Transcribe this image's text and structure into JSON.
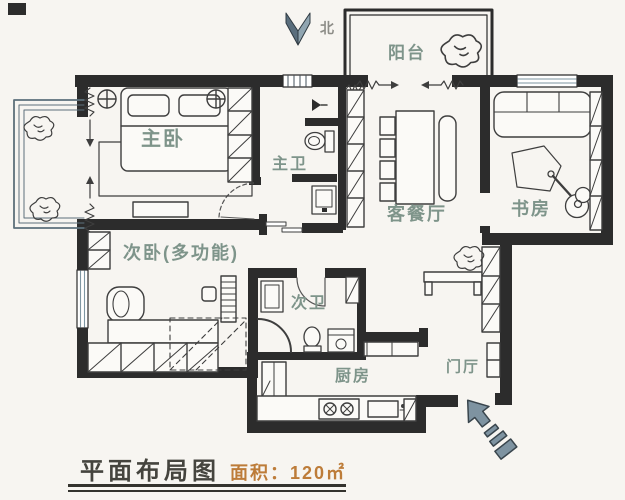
{
  "title_block": {
    "title": "平面布局图",
    "area": "面积：120㎡"
  },
  "compass": {
    "north_label": "北"
  },
  "rooms": {
    "master_bedroom": {
      "label": "主卧"
    },
    "master_bath": {
      "label": "主卫"
    },
    "second_bedroom": {
      "label": "次卧(多功能)"
    },
    "second_bath": {
      "label": "次卫"
    },
    "kitchen": {
      "label": "厨房"
    },
    "living_dining": {
      "label": "客餐厅"
    },
    "study": {
      "label": "书房"
    },
    "balcony": {
      "label": "阳台"
    },
    "entry_hall": {
      "label": "门厅"
    }
  },
  "icons": {
    "north_arrow": "compass-chevron",
    "entrance_arrow": "entry-direction-arrow",
    "plants": "plant-scribble"
  },
  "colors": {
    "wall": "#2c2c2c",
    "furniture_line": "#3e3e3e",
    "window_line": "#7e96a2",
    "room_label": "#7e948a",
    "area_accent": "#bd7c39",
    "arrow_fill": "#7e93a1",
    "title_text": "#45443e",
    "background": "#f7f5f1"
  }
}
